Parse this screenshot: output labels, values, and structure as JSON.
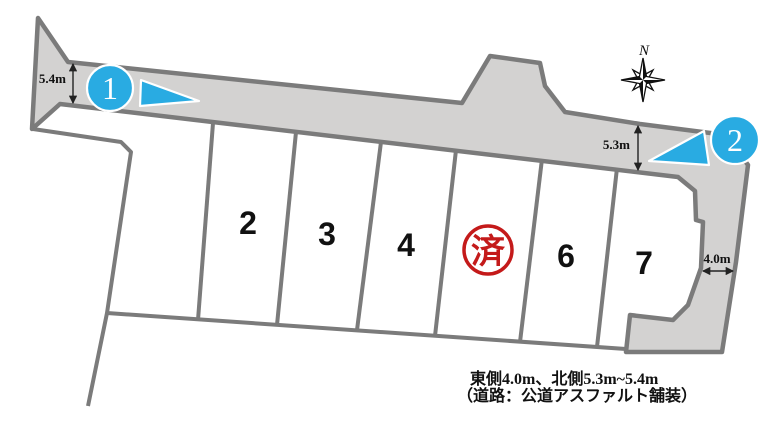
{
  "measurements": {
    "north_west": "5.4m",
    "north_east": "5.3m",
    "east": "4.0m"
  },
  "compass": {
    "north_label": "N"
  },
  "photo_markers": [
    {
      "label": "1"
    },
    {
      "label": "2"
    }
  ],
  "lots": [
    {
      "label": "2",
      "status": "available"
    },
    {
      "label": "3",
      "status": "available"
    },
    {
      "label": "4",
      "status": "available"
    },
    {
      "label": "済",
      "status": "sold"
    },
    {
      "label": "6",
      "status": "available"
    },
    {
      "label": "7",
      "status": "available"
    }
  ],
  "notes": {
    "line1": "東側4.0m、北側5.3m~5.4m",
    "line2": "（道路：公道アスファルト舗装）"
  },
  "colors": {
    "road_fill": "#d3d2d1",
    "boundary_gray": "#7b7b7b",
    "marker_blue": "#29abe2",
    "sold_red": "#c41a1a",
    "text_black": "#111111"
  }
}
